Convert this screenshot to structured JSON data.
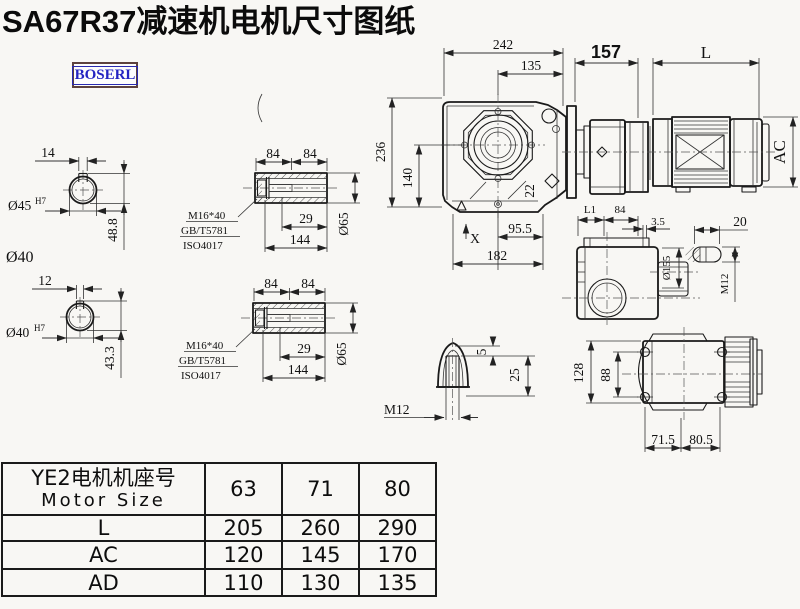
{
  "title": "SA67R37减速机电机尺寸图纸",
  "logo": {
    "text": "BOSERL"
  },
  "colors": {
    "line": "#1a1a1a",
    "logo_text": "#2424c2",
    "logo_border": "#5d423e",
    "background": "#f8f7f4"
  },
  "views": {
    "bore_input": {
      "key_width": "14",
      "bore_dia": "Ø45",
      "fit": "H7",
      "depth": "48.8",
      "label_od": "Ø40"
    },
    "bore_output": {
      "key_width": "12",
      "bore_dia": "Ø40",
      "fit": "H7",
      "depth": "43.3"
    },
    "hollow_shaft": {
      "len_a": "84",
      "len_b": "84",
      "bolt": "M16*40",
      "std_gb": "GB/T5781",
      "std_iso": "ISO4017",
      "bore_len": "29",
      "total_len": "144",
      "dia": "Ø65"
    },
    "front": {
      "width": "242",
      "width_upper": "135",
      "height": "236",
      "center_height": "140",
      "plug": "22",
      "base_a": "95.5",
      "base_b": "182",
      "datum": "X"
    },
    "motor": {
      "gear_len": "157",
      "motor_len": "L",
      "motor_dia": "AC"
    },
    "side": {
      "l1": "L1",
      "d84": "84",
      "gap": "3.5",
      "slot_len": "20",
      "flange_dia": "Ø155",
      "thread": "M12"
    },
    "breather": {
      "cap": "5",
      "depth": "25",
      "thread": "M12"
    },
    "top": {
      "height": "128",
      "bolt_span": "88",
      "foot_a": "71.5",
      "foot_b": "80.5"
    }
  },
  "table": {
    "header_cn": "YE2电机机座号",
    "header_en": "Motor Size",
    "sizes": [
      "63",
      "71",
      "80"
    ],
    "rows": [
      {
        "label": "L",
        "values": [
          "205",
          "260",
          "290"
        ]
      },
      {
        "label": "AC",
        "values": [
          "120",
          "145",
          "170"
        ]
      },
      {
        "label": "AD",
        "values": [
          "110",
          "130",
          "135"
        ]
      }
    ]
  }
}
